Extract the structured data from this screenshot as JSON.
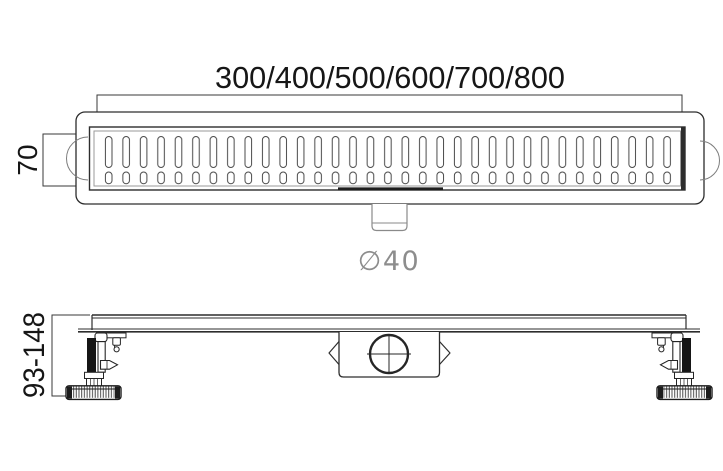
{
  "drawing": {
    "background_color": "#ffffff",
    "line_color": "#2d2d2d",
    "light_line_color": "#8a8a8a",
    "dim_text_color": "#161616",
    "outlet_text_color": "#8d8d8d",
    "top_view": {
      "length_dimension": {
        "label": "300/400/500/600/700/800"
      },
      "width_dimension": {
        "label": "70"
      },
      "outlet": {
        "diameter_label": "∅40"
      },
      "grate": {
        "slot_columns": 33,
        "slot_rows": 2
      }
    },
    "side_view": {
      "height_dimension": {
        "label": "93-148"
      }
    }
  }
}
